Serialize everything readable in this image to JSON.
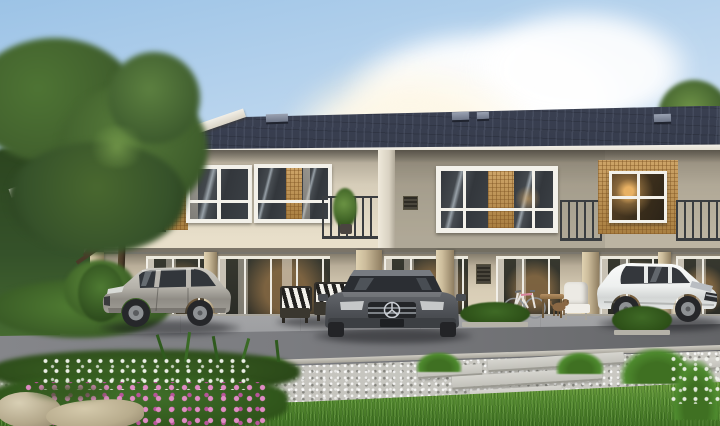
{
  "canvas": {
    "width": 720,
    "height": 426
  },
  "scene": {
    "description": "Daytime 3D architectural rendering of a modern two-storey townhouse row: dark charcoal tiled roof, cream walls with rattan-wood window panels, dark louver screens and metal balcony railings; ground-floor porches with glass sliding doors; a silver SUV, a dark grey SUV and a white SUV parked in front; patio furniture with striped cushions, a bicycle, a small dog, planters; asphalt road, gravel path with concrete stepping slabs, green lawn and a pink-and-white flower bed with rocks; large tree and hedge on the left, blue sky with cumulus clouds."
  },
  "labels": {
    "sky": "Blue sky with clouds",
    "tree": "Tree on the left",
    "hedge": "Green hedge",
    "building": "Two-storey townhouse row",
    "roof": "Dark tiled roof",
    "upper_floor": "Upper floor facade",
    "ground_floor": "Ground floor porches",
    "carport": "Carport",
    "silver_suv": "Silver SUV",
    "gray_suv": "Dark grey SUV",
    "white_suv": "White SUV",
    "patio_set": "Patio furniture with striped cushions",
    "side_chair": "White porch chair",
    "side_table": "Small wooden table",
    "dog": "Small dog",
    "bicycle": "Bicycle",
    "planter": "Shrub planter",
    "road": "Asphalt road",
    "path": "Gravel path with stepping slabs",
    "lawn": "Green lawn",
    "garden": "Flower bed with rocks"
  },
  "colors": {
    "sky_top": "#9cc3e6",
    "sky_mid": "#c6dcf1",
    "sky_low": "#e8f1f8",
    "cloud_white": "#ffffff",
    "sun_glow": "#fdf6e3",
    "roof_light": "#454b5e",
    "roof_mid": "#333949",
    "roof_dark": "#232838",
    "roof_vent": "#9aa2b2",
    "fascia_white": "#f2efe7",
    "wall_cream": "#d6cdb9",
    "wall_cream_light": "#e8dfca",
    "wall_taupe": "#8f897b",
    "wood_light": "#cda468",
    "wood_dark": "#a97f41",
    "frame_white": "#f3f1ea",
    "glass_dark": "#33373c",
    "glass_light": "#98a1a8",
    "curtain": "#e2dacb",
    "interior_warm": "#b98a52",
    "lamp_glow": "#e8b163",
    "railing": "#3a3d40",
    "louver_dark": "#26251f",
    "louver_light": "#514f48",
    "column_light": "#cdbd9c",
    "column_dark": "#8f7e61",
    "soffit": "#6b655a",
    "lower_wall": "#d8cdb6",
    "plinth": "#a9a69d",
    "driveway": "#9c9da0",
    "road": "#7b7c80",
    "road_dark": "#636467",
    "curb": "#cfccc3",
    "gravel": "#c6c5bf",
    "slab": "#d6d5cf",
    "slab_edge": "#9b9a92",
    "grass_light": "#6fa03f",
    "grass_mid": "#558a30",
    "grass_dark": "#3f7022",
    "foliage_dark": "#2c451f",
    "foliage_mid": "#41602d",
    "foliage_light": "#6f9448",
    "flower_pink": "#e08cc4",
    "flower_magenta": "#b8549a",
    "flower_white": "#f4f6f0",
    "rock_light": "#d8cfb4",
    "rock_dark": "#8c8068",
    "trunk_brown": "#4a3a28",
    "car_silver": "#b4b1a9",
    "car_silver_dark": "#8f8c85",
    "car_graphite": "#4c4f54",
    "car_white": "#eef0ef",
    "tire_black": "#26272a",
    "rim_gray": "#8e9194",
    "chrome": "#c9cdd3",
    "headlight": "#d8dad6"
  }
}
